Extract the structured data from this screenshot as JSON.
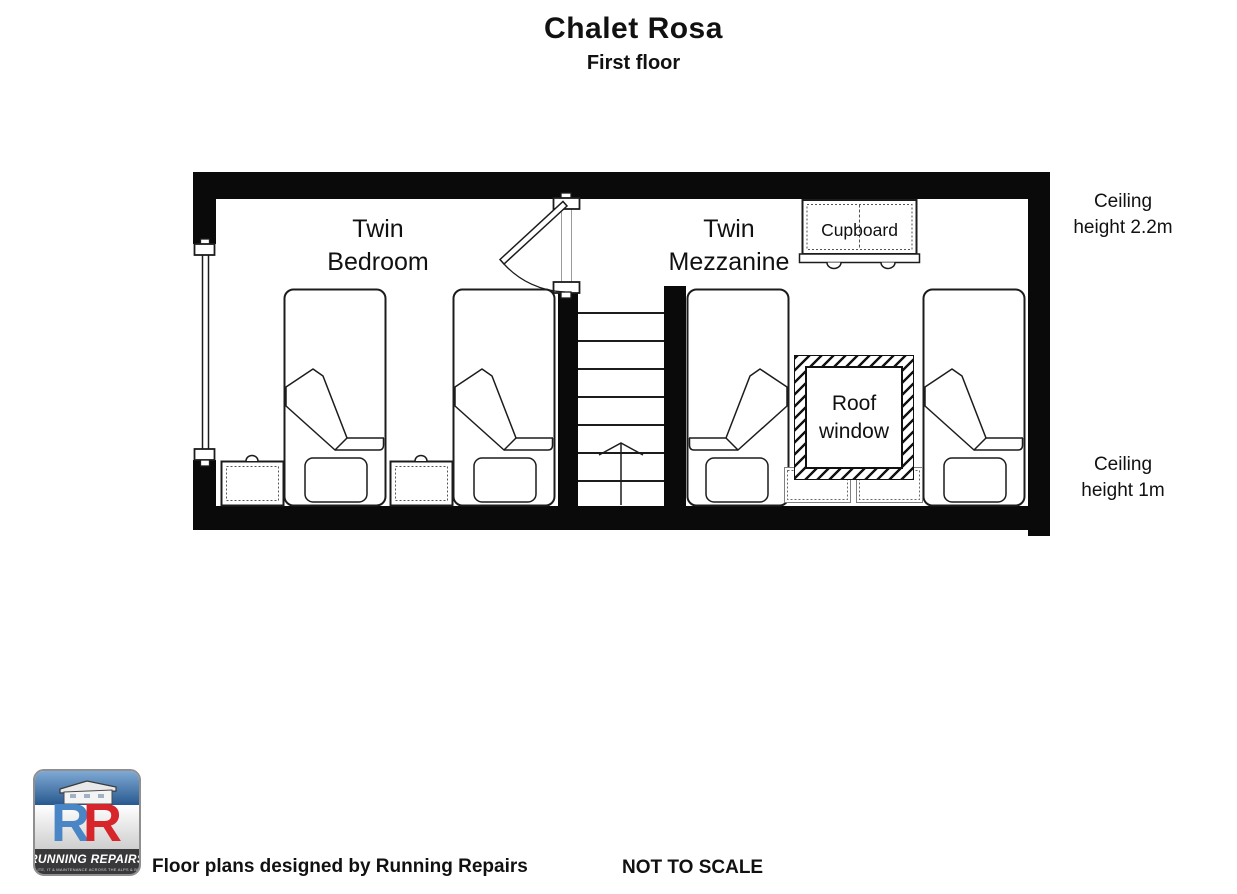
{
  "title": "Chalet Rosa",
  "subtitle": "First floor",
  "rooms": {
    "bedroom": {
      "line1": "Twin",
      "line2": "Bedroom"
    },
    "mezzanine": {
      "line1": "Twin",
      "line2": "Mezzanine"
    }
  },
  "furniture": {
    "cupboard_label": "Cupboard",
    "roof_window_line1": "Roof",
    "roof_window_line2": "window"
  },
  "annotations": {
    "ceiling_upper_line1": "Ceiling",
    "ceiling_upper_line2": "height 2.2m",
    "ceiling_lower_line1": "Ceiling",
    "ceiling_lower_line2": "height 1m"
  },
  "footer": {
    "credit": "Floor plans designed by Running Repairs",
    "scale_note": "NOT TO SCALE"
  },
  "logo": {
    "monogram_left": "R",
    "monogram_right": "R",
    "brand": "RUNNING REPAIRS",
    "tagline": "SATELLITE, IT & MAINTENANCE ACROSS THE ALPS & BEYOND"
  },
  "colors": {
    "wall": "#0a0a0a",
    "line": "#1c1c1c",
    "logo_blue": "#4a86c5",
    "logo_red": "#d6252b",
    "logo_band": "#39393b",
    "logo_sky": "#28598f"
  }
}
